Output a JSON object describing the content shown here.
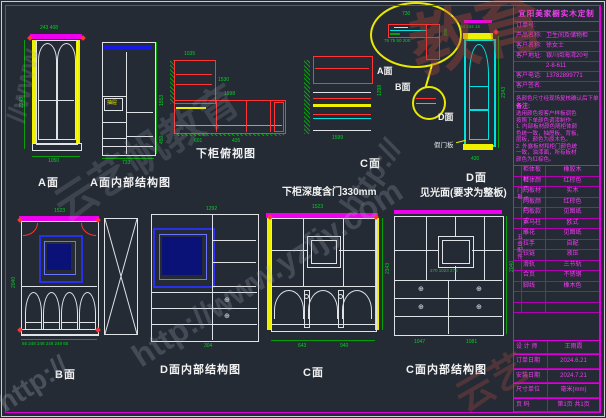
{
  "watermark": {
    "brand": "云艺帆教育",
    "edu": "教育",
    "cloud": "云艺",
    "url": "http://www.yzfjy.com",
    "protocol": "http://",
    "www": "//www"
  },
  "labels": {
    "a_face": "A面",
    "a_inner": "A面内部结构图",
    "plan_top": "下柜俯视图",
    "c_plan": "C面",
    "depth_note": "下柜深度含门330mm",
    "d_face": "D面",
    "d_note": "见光面(要求为整板)",
    "b_face": "B面",
    "d_inner": "D面内部结构图",
    "c_face": "C面",
    "c_inner": "C面内部结构图",
    "arrow_a": "A面",
    "arrow_b": "B面",
    "arrow_d": "D面",
    "fake_door": "假门板",
    "drawer": "抽屉"
  },
  "dims": {
    "a_face": {
      "top": "243 408",
      "left": "2343",
      "bottom": "1050"
    },
    "a_inner": {
      "right_top": "1553",
      "right_mid": "450",
      "bottom": "733"
    },
    "plan_top": {
      "top": "1035",
      "inner": "1530",
      "strip": "1998",
      "b1": "601",
      "b2": "435"
    },
    "c_plan": {
      "right": "1298",
      "bottom": "1599"
    },
    "detail": {
      "top": "730",
      "row": "75 75 50 200",
      "side": "200"
    },
    "d_face": {
      "top": "54 234 15",
      "right": "2343",
      "bottom": "430"
    },
    "b_face": {
      "top": "1523",
      "left": "2040",
      "bottom": "65 248 248 248 249 65"
    },
    "d_inner": {
      "top": "1292",
      "bottom": "304"
    },
    "c_face": {
      "top": "1523",
      "right": "2343",
      "b1": "643",
      "b2": "940"
    },
    "c_inner": {
      "mid": "270 1023 276",
      "b1": "1047",
      "b2": "1081",
      "right": "2040"
    }
  },
  "titleblock": {
    "title": "宜阳美家橱实木定制",
    "fields": [
      {
        "label": "订单号:",
        "value": ""
      },
      {
        "label": "产品名称:",
        "value": "卫生间及储物柜"
      },
      {
        "label": "客户名称:",
        "value": "徐女士"
      },
      {
        "label": "客户地址:",
        "value": "银川阅海湾20号"
      },
      {
        "label": "",
        "value": "2-8-611"
      },
      {
        "label": "客户电话:",
        "value": "13782899771"
      },
      {
        "label": "客户签名:",
        "value": ""
      }
    ],
    "notes": {
      "warning": "各颜色尺寸经现场复核确认后下单",
      "title": "备注:",
      "lines": [
        "选用颜色按客户样板调色",
        "按照下单颜色调漆制作:",
        "1. 内部板材颜色随柜体颜",
        "色统一致，抽屉板、背板、",
        "层板，颜色为原木色。",
        "2. 外露板材和柜门颜色统",
        "一致，油漆面，所有板材",
        "颜色为红棕色。"
      ]
    },
    "groups": {
      "door": "门板",
      "hardware": "五金配件"
    },
    "table": [
      {
        "label": "柜体板材",
        "value": "橡胶木"
      },
      {
        "label": "柜体颜色",
        "value": "红棕色"
      },
      {
        "label": "门板材质",
        "value": "实木"
      },
      {
        "label": "门板颜色",
        "value": "红棕色"
      },
      {
        "label": "门板款式",
        "value": "见图纸"
      },
      {
        "label": "罗马柱",
        "value": "欧式"
      },
      {
        "label": "雕花",
        "value": "见图纸"
      },
      {
        "label": "拉手",
        "value": "自配"
      },
      {
        "label": "铰链",
        "value": "液压"
      },
      {
        "label": "滑轨",
        "value": "三节轨"
      },
      {
        "label": "合页",
        "value": "不锈钢"
      },
      {
        "label": "脚线",
        "value": "橡木色"
      },
      {
        "label": "",
        "value": ""
      },
      {
        "label": "",
        "value": ""
      }
    ],
    "footer": [
      {
        "label": "设 计 师",
        "value": "王雨霞"
      },
      {
        "label": "订单日期",
        "value": "2024.6.21"
      },
      {
        "label": "安装日期",
        "value": "2024.7.21"
      },
      {
        "label": "尺寸单位",
        "value": "毫米(mm)"
      },
      {
        "label": "页    码",
        "value": "第1页  共1页"
      }
    ]
  }
}
